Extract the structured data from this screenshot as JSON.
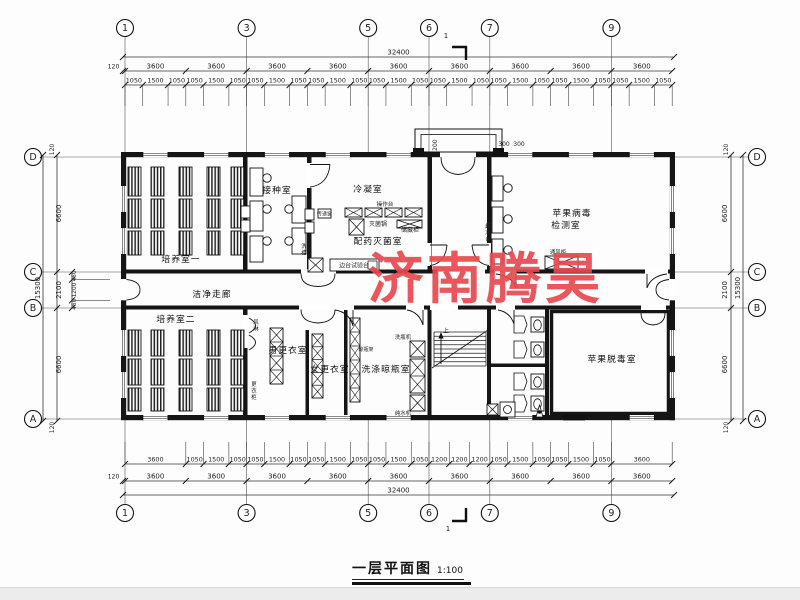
{
  "title_block": {
    "text": "一层平面图",
    "scale": "1:100"
  },
  "watermark": {
    "text": "济南腾昊",
    "color": "#e8494f"
  },
  "section_mark": {
    "label": "1"
  },
  "axes": {
    "top_bottom": [
      {
        "label": "1",
        "n": 1
      },
      {
        "label": "3",
        "n": 3
      },
      {
        "label": "5",
        "n": 5
      },
      {
        "label": "6",
        "n": 6
      },
      {
        "label": "7",
        "n": 7
      },
      {
        "label": "9",
        "n": 9
      }
    ],
    "left_right": [
      {
        "label": "D",
        "row": "D"
      },
      {
        "label": "C",
        "row": "C"
      },
      {
        "label": "B",
        "row": "B"
      },
      {
        "label": "A",
        "row": "A"
      }
    ]
  },
  "dimensions": {
    "top": {
      "overall": "32400",
      "edge": "120",
      "bays": [
        "3600",
        "3600",
        "3600",
        "3600",
        "3600",
        "3600",
        "3600",
        "3600",
        "3600"
      ],
      "sub": [
        "1050",
        "1500",
        "1050",
        "1050",
        "1500",
        "1050",
        "1050",
        "1500",
        "1050",
        "1050",
        "1500",
        "1050",
        "1050",
        "1500",
        "1050",
        "1050",
        "1500",
        "1050",
        "1050",
        "1500",
        "1050",
        "1050",
        "1500",
        "1050",
        "1050",
        "1500",
        "1050"
      ]
    },
    "bottom": {
      "overall": "32400",
      "edge": "120",
      "bays": [
        "3600",
        "3600",
        "3600",
        "3600",
        "3600",
        "3600",
        "3600",
        "3600",
        "3600"
      ],
      "sub": [
        "3600",
        "1050",
        "1500",
        "1050",
        "1050",
        "1500",
        "1050",
        "1050",
        "1500",
        "1050",
        "1050",
        "1500",
        "1050",
        "1200",
        "1200",
        "1200",
        "1050",
        "1500",
        "1050",
        "1050",
        "1500",
        "1050",
        "3600"
      ]
    },
    "left": {
      "overall": "15300",
      "edge_top": "120",
      "edge_bottom": "120",
      "segments": [
        "6600",
        "2100",
        "6600"
      ],
      "sub": [
        "450",
        "1200",
        "450"
      ]
    },
    "right": {
      "overall": "15300",
      "edge_top": "120",
      "edge_bottom": "120",
      "segments": [
        "6600",
        "2100",
        "6600"
      ]
    },
    "entrance": [
      {
        "text": "1200",
        "x": 437,
        "y": 147,
        "rot": true
      },
      {
        "text": "300",
        "x": 504,
        "y": 146
      },
      {
        "text": "300",
        "x": 519,
        "y": 146
      }
    ]
  },
  "room_labels": [
    {
      "text": "培养室一",
      "x": 181,
      "y": 262
    },
    {
      "text": "接种室",
      "x": 277,
      "y": 193
    },
    {
      "text": "冷凝室",
      "x": 368,
      "y": 192
    },
    {
      "text": "配药灭菌室",
      "x": 378,
      "y": 244
    },
    {
      "text": "苹果病毒",
      "x": 572,
      "y": 216
    },
    {
      "text": "检测室",
      "x": 566,
      "y": 228
    },
    {
      "text": "洁净走廊",
      "x": 212,
      "y": 297
    },
    {
      "text": "培养室二",
      "x": 176,
      "y": 322
    },
    {
      "text": "男更衣室",
      "x": 288,
      "y": 353
    },
    {
      "text": "女更衣室",
      "x": 330,
      "y": 372
    },
    {
      "text": "洗涤晾瓶室",
      "x": 386,
      "y": 372
    },
    {
      "text": "苹果脱毒室",
      "x": 612,
      "y": 362
    }
  ],
  "equipment_labels": [
    {
      "text": "操作台",
      "x": 385,
      "y": 206,
      "fs": 5.6
    },
    {
      "text": "灭菌锅",
      "x": 378,
      "y": 226,
      "fs": 6
    },
    {
      "text": "储藏柜",
      "x": 410,
      "y": 232,
      "fs": 6
    },
    {
      "text": "传递窗",
      "x": 324.5,
      "y": 215.5,
      "fs": 5
    },
    {
      "text": "洗槽",
      "x": 304,
      "y": 248,
      "fs": 5.4,
      "vertical": true
    },
    {
      "text": "边台试验台",
      "x": 354,
      "y": 267.5,
      "fs": 6
    },
    {
      "text": "超净台",
      "x": 488,
      "y": 228,
      "fs": 5.4,
      "vertical": true
    },
    {
      "text": "通风柜",
      "x": 558,
      "y": 254,
      "fs": 5.4
    },
    {
      "text": "风淋",
      "x": 256,
      "y": 324,
      "fs": 5.4,
      "vertical": true
    },
    {
      "text": "洗瓶机",
      "x": 403,
      "y": 339,
      "fs": 5.4
    },
    {
      "text": "纯水机",
      "x": 403,
      "y": 415,
      "fs": 5.4
    },
    {
      "text": "晾瓶架",
      "x": 366,
      "y": 351,
      "fs": 5
    },
    {
      "text": "更衣柜",
      "x": 254,
      "y": 386,
      "fs": 5.4,
      "vertical": true
    },
    {
      "text": "上",
      "x": 446,
      "y": 333,
      "fs": 6
    }
  ]
}
